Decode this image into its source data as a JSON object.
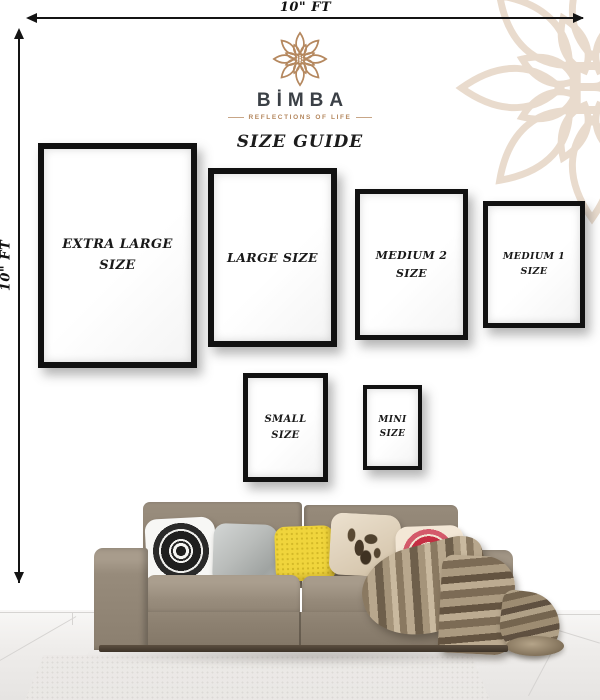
{
  "poster": {
    "kind": "frame-size-guide",
    "title": "SIZE GUIDE"
  },
  "dimensions": {
    "top_label": "10\" FT",
    "left_label": "10\" FT"
  },
  "brand": {
    "monogram": "B",
    "name": "BİMBA",
    "tagline": "REFLECTIONS OF LIFE",
    "accent_color": "#b5885f",
    "watermark_color": "#e9dbcd",
    "name_color": "#3b4046"
  },
  "frames": [
    {
      "id": "extra-large",
      "lines": [
        "EXTRA LARGE",
        "SIZE"
      ]
    },
    {
      "id": "large",
      "lines": [
        "LARGE SIZE",
        ""
      ]
    },
    {
      "id": "medium-2",
      "lines": [
        "MEDIUM 2",
        "SIZE"
      ]
    },
    {
      "id": "medium-1",
      "lines": [
        "MEDIUM 1",
        "SIZE"
      ]
    },
    {
      "id": "small",
      "lines": [
        "SMALL",
        "SIZE"
      ]
    },
    {
      "id": "mini",
      "lines": [
        "MINI",
        "SIZE"
      ]
    }
  ],
  "scene": {
    "frame_border_color": "#111111",
    "wall_color": "#ffffff",
    "floor_color": "#efedec",
    "sofa_color": "#8f8373",
    "blanket_color": "#a3927a",
    "pillows": [
      {
        "name": "black-white-mandala",
        "color": "#f5f5f3"
      },
      {
        "name": "plain-gray",
        "color": "#b9bcba"
      },
      {
        "name": "yellow-dotted",
        "color": "#f0d53c"
      },
      {
        "name": "beige-floral",
        "color": "#d9cab2"
      },
      {
        "name": "red-mandala",
        "color": "#c62f44"
      }
    ]
  }
}
